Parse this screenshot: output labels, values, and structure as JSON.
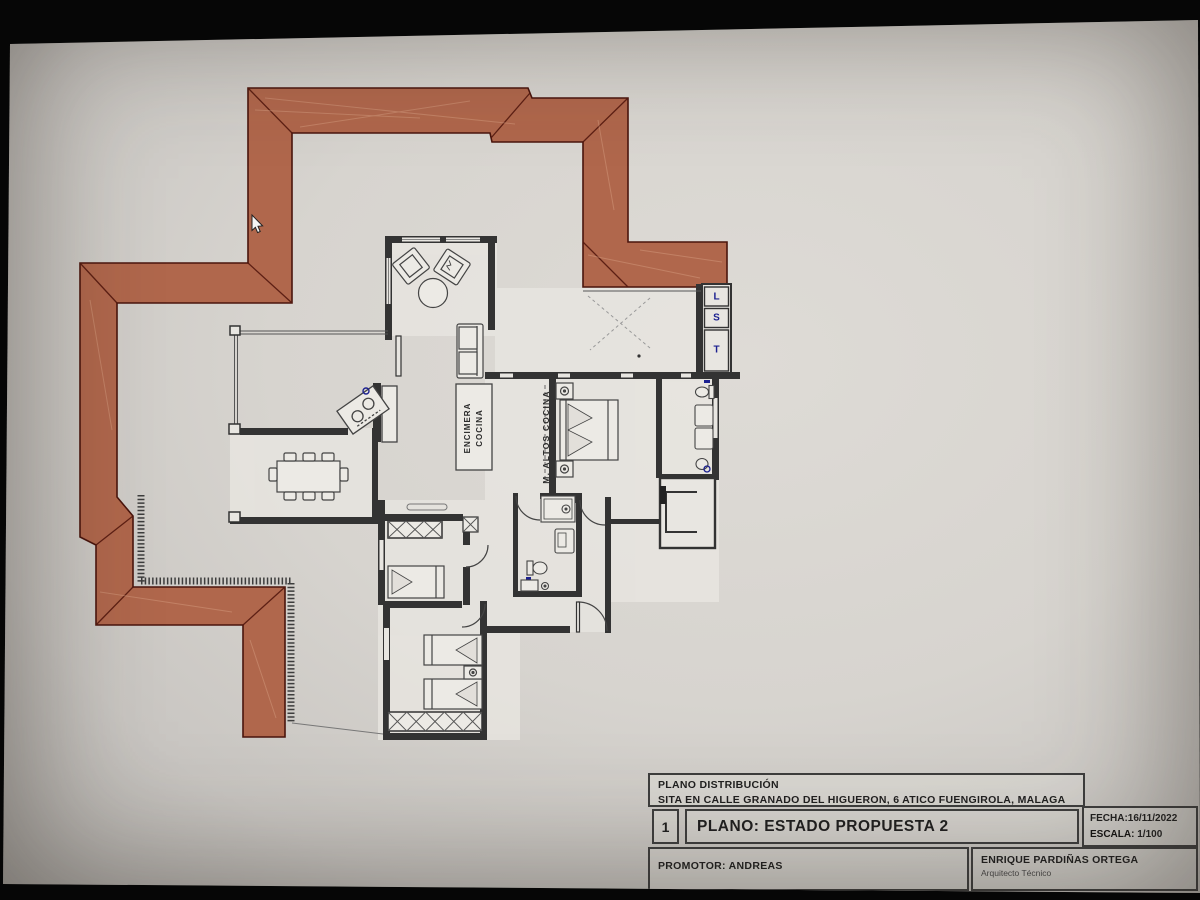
{
  "colors": {
    "roof": "#b0674c",
    "roof_edge": "#4a150d",
    "wall": "#333333",
    "accent_blue": "#1b2090"
  },
  "plan": {
    "labels": {
      "counter_line1": "ENCIMERA",
      "counter_line2": "COCINA",
      "upper_cabinets": "M. ALTOS COCINA",
      "appliance_l": "L",
      "appliance_s": "S",
      "appliance_t": "T"
    }
  },
  "title_block": {
    "doc_title": "PLANO DISTRIBUCIÓN",
    "address": "SITA EN CALLE GRANADO DEL HIGUERON, 6 ATICO FUENGIROLA, MALAGA",
    "sheet_number": "1",
    "plan_name": "PLANO: ESTADO PROPUESTA 2",
    "date": "FECHA:16/11/2022",
    "scale_label": "ESCALA:",
    "scale_value": "1/100",
    "promoter": "PROMOTOR: ANDREAS",
    "architect_name": "ENRIQUE PARDIÑAS ORTEGA",
    "architect_title": "Arquitecto Técnico"
  }
}
